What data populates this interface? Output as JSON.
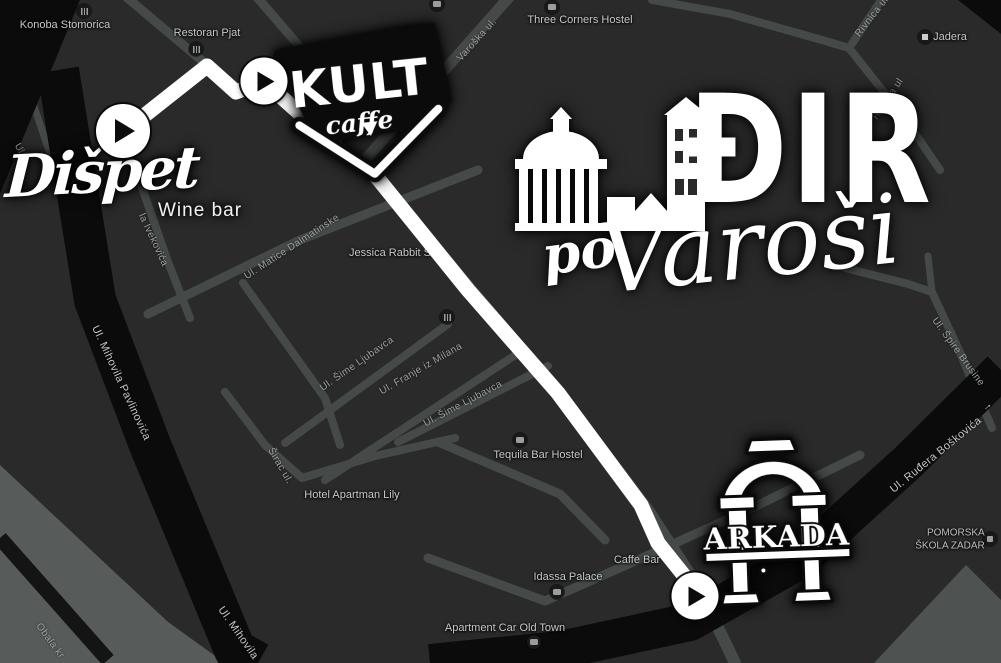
{
  "map": {
    "colors": {
      "background": "#2a2a2b",
      "road": "#454a49",
      "road_major_dark": "#0b0b0c",
      "waterfront": "#575c5a",
      "route": "#ffffff",
      "poi_label": "#c6c9c4",
      "street_label": "#9da19e",
      "street_label_on_dark": "#c3c7c4"
    },
    "pois": [
      {
        "label": "Konoba Stomorica",
        "icon": "restaurant"
      },
      {
        "label": "Restoran Pjat",
        "icon": "restaurant"
      },
      {
        "label": "",
        "icon": "lodging"
      },
      {
        "label": "Three Corners Hostel",
        "icon": "lodging"
      },
      {
        "label": "Jadera",
        "icon": "place"
      },
      {
        "label": "Jessica Rabbit S",
        "icon": ""
      },
      {
        "label": "",
        "icon": "restaurant"
      },
      {
        "label": "Tequila Bar Hostel",
        "icon": "lodging"
      },
      {
        "label": "Hotel Apartman Lily",
        "icon": ""
      },
      {
        "label": "Idassa Palace",
        "icon": "lodging"
      },
      {
        "label": "Caffe Bar",
        "icon": ""
      },
      {
        "label": "Apartment Car Old Town",
        "icon": "lodging"
      },
      {
        "label": "POMORSKA",
        "label2": "ŠKOLA ZADAR",
        "icon": "school"
      },
      {
        "label": "ar Ap",
        "icon": ""
      },
      {
        "label": "ky Bar",
        "icon": ""
      }
    ],
    "streets": [
      {
        "name": "Varoška ul."
      },
      {
        "name": "Rivnica ul"
      },
      {
        "name": "Rivnica ul"
      },
      {
        "name": "Ul. Matice Dalmatinske"
      },
      {
        "name": "Ul. Šime Ljubavca"
      },
      {
        "name": "Ul. Franje iz Milana"
      },
      {
        "name": "Ul. Šime Ljubavca"
      },
      {
        "name": "Širac ul."
      },
      {
        "name": "Ul. Mihovila Pavlinovića"
      },
      {
        "name": "Ul. Mihovila"
      },
      {
        "name": "Obala kr"
      },
      {
        "name": "Ul. Špire Brusine"
      },
      {
        "name": "Ul. Ruđera Boškovića",
        "arrow": "→"
      },
      {
        "name": "la Ivekovića"
      },
      {
        "name": "Ul."
      }
    ]
  },
  "branding": {
    "event": {
      "title": "ĐIR",
      "subtitle_pre": "po",
      "subtitle": "Varoši"
    },
    "kult": {
      "name": "KULT",
      "descriptor": "caffe"
    },
    "dispet": {
      "name": "Dišpet",
      "descriptor": "Wine bar"
    },
    "arkada": {
      "name": "ARKADA"
    }
  }
}
